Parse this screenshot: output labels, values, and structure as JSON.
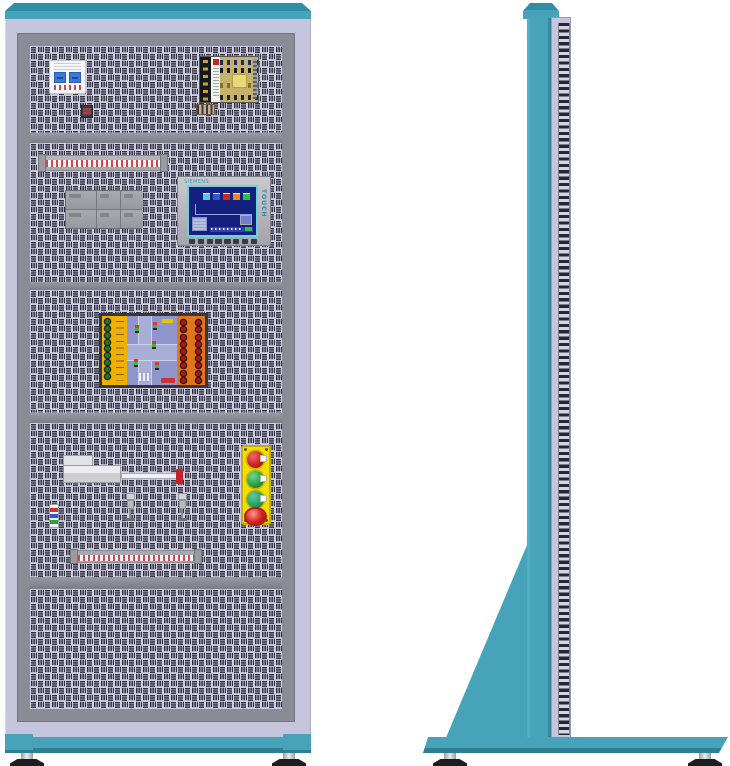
{
  "scene": {
    "subject": "Electrical training cabinet technical illustration",
    "views": [
      "front elevation",
      "side elevation"
    ],
    "background": "#ffffff"
  },
  "palette": {
    "teal": "#47a3ba",
    "teal-dark": "#2f8da6",
    "lavender": "#c6c5de",
    "panel-bg": "#d0cfe8",
    "slot": "#2d2d38",
    "frame-gray": "#8b8b95",
    "divider-gray": "#8d8d97",
    "screen-blue": "#13207e",
    "station-yellow": "#f2df00",
    "board-left": "#f0b000",
    "board-right": "#e0761a",
    "board-field": "#8f96cc",
    "foot": "#1d1d20"
  },
  "front": {
    "sections": [
      {
        "id": "top-bay",
        "components": [
          "circuit-breaker",
          "din-connector",
          "switching-power-supply",
          "output-connector"
        ]
      },
      {
        "id": "control-bay",
        "components": [
          "terminal-strip",
          "plc-module",
          "hmi-touch-panel"
        ]
      },
      {
        "id": "trainer-bay",
        "components": [
          "traffic-light-training-board"
        ]
      },
      {
        "id": "actuation-bay",
        "components": [
          "linear-actuator",
          "inductive-sensor",
          "inductive-sensor",
          "signal-board",
          "pushbutton-station",
          "terminal-strip"
        ]
      },
      {
        "id": "empty-bay",
        "components": []
      }
    ]
  },
  "hmi": {
    "brand": "SIEMENS",
    "side_label": "TOUCH"
  },
  "pushbutton_station": {
    "buttons": [
      {
        "color": "red",
        "type": "push"
      },
      {
        "color": "green",
        "type": "push"
      },
      {
        "color": "green",
        "type": "push"
      },
      {
        "color": "red",
        "type": "emergency-stop"
      }
    ]
  },
  "side": {
    "features": [
      "top-cap",
      "column",
      "perforated-panel-edge",
      "support-gusset",
      "floor-base",
      "leveling-feet"
    ]
  }
}
